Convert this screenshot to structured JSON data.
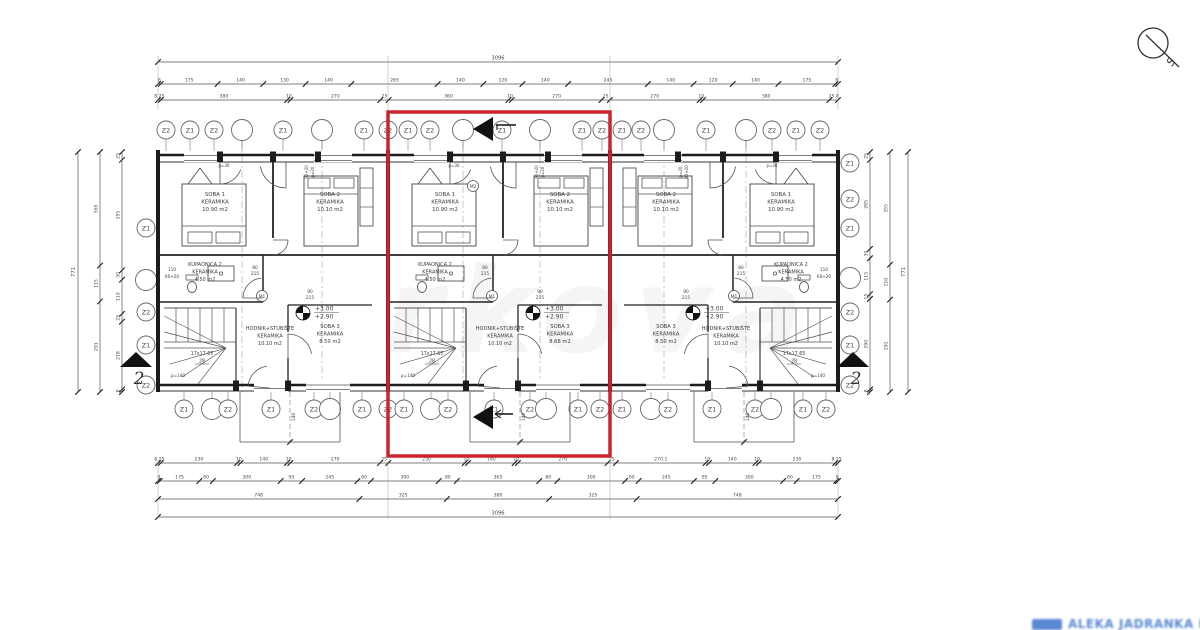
{
  "colors": {
    "line": "#555555",
    "dark": "#1c1c1c",
    "text": "#3c3c3c",
    "dim": "#474747",
    "red": "#c9252d",
    "blue": "#4c7fd0",
    "grid": "#8a8a8a"
  },
  "compass": {
    "label": "S"
  },
  "section_label": "2",
  "watermark_center": "rkova",
  "watermark_bottom": "ALEKA JADRANKA DJENĐ",
  "highlight": {
    "x": 388,
    "y": 112,
    "w": 222,
    "h": 344
  },
  "dim_rows_top": [
    {
      "y": 62,
      "x0": 158,
      "x1": 838,
      "single": true,
      "values": [
        "3096"
      ]
    },
    {
      "y": 84,
      "x0": 158,
      "x1": 838,
      "values": [
        8,
        175,
        140,
        130,
        140,
        265,
        140,
        120,
        140,
        245,
        140,
        120,
        140,
        175,
        8
      ]
    },
    {
      "y": 100,
      "x0": 158,
      "x1": 838,
      "values": [
        8.25,
        380,
        10,
        270,
        25,
        360,
        10,
        270,
        25,
        270,
        10,
        380,
        25.8
      ]
    }
  ],
  "dim_rows_bottom": [
    {
      "y": 463,
      "x0": 158,
      "x1": 838,
      "values": [
        8.25,
        230,
        10,
        140,
        10,
        270,
        25,
        230,
        10,
        140,
        10,
        270,
        25,
        270.1,
        10,
        140,
        10,
        230,
        8.25
      ]
    },
    {
      "y": 481,
      "x0": 158,
      "x1": 838,
      "values": [
        8,
        175,
        60,
        300,
        95,
        245,
        60,
        300,
        80,
        365,
        80,
        300,
        60,
        245,
        95,
        300,
        60,
        175,
        8
      ]
    },
    {
      "y": 499,
      "x0": 158,
      "x1": 838,
      "values": [
        748,
        325,
        380,
        325,
        748
      ]
    },
    {
      "y": 517,
      "x0": 158,
      "x1": 838,
      "single": true,
      "values": [
        "3096"
      ]
    }
  ],
  "dim_cols_left": [
    {
      "x": 78,
      "y0": 152,
      "y1": 392,
      "single": true,
      "values": [
        "771"
      ]
    },
    {
      "x": 100,
      "y0": 152,
      "y1": 392,
      "values": [
        365,
        115,
        291
      ]
    },
    {
      "x": 122,
      "y0": 152,
      "y1": 392,
      "values": [
        25,
        355,
        30,
        110,
        25,
        218,
        8
      ]
    }
  ],
  "dim_cols_right": [
    {
      "x": 870,
      "y0": 152,
      "y1": 392,
      "values": [
        25,
        285,
        30,
        115,
        15,
        290,
        8
      ]
    },
    {
      "x": 890,
      "y0": 152,
      "y1": 392,
      "values": [
        355,
        110,
        291
      ]
    },
    {
      "x": 908,
      "y0": 152,
      "y1": 392,
      "single": true,
      "values": [
        "771"
      ]
    }
  ],
  "grid_top": [
    {
      "x": 166,
      "label": "Z2"
    },
    {
      "x": 190,
      "label": "Z1"
    },
    {
      "x": 214,
      "label": "Z2"
    },
    {
      "x": 242,
      "label": ""
    },
    {
      "x": 283,
      "label": "Z1"
    },
    {
      "x": 322,
      "label": ""
    },
    {
      "x": 364,
      "label": "Z1"
    },
    {
      "x": 388,
      "label": "Z2"
    },
    {
      "x": 408,
      "label": "Z1"
    },
    {
      "x": 430,
      "label": "Z2"
    },
    {
      "x": 463,
      "label": ""
    },
    {
      "x": 502,
      "label": "Z1"
    },
    {
      "x": 540,
      "label": ""
    },
    {
      "x": 582,
      "label": "Z1"
    },
    {
      "x": 602,
      "label": "Z2"
    },
    {
      "x": 622,
      "label": "Z1"
    },
    {
      "x": 641,
      "label": "Z2"
    },
    {
      "x": 664,
      "label": ""
    },
    {
      "x": 706,
      "label": "Z1"
    },
    {
      "x": 746,
      "label": ""
    },
    {
      "x": 772,
      "label": "Z2"
    },
    {
      "x": 796,
      "label": "Z1"
    },
    {
      "x": 820,
      "label": "Z2"
    }
  ],
  "grid_bottom": [
    {
      "x": 184,
      "label": "Z1"
    },
    {
      "x": 212,
      "label": ""
    },
    {
      "x": 228,
      "label": "Z2"
    },
    {
      "x": 271,
      "label": "Z1"
    },
    {
      "x": 314,
      "label": "Z2"
    },
    {
      "x": 330,
      "label": ""
    },
    {
      "x": 362,
      "label": "Z1"
    },
    {
      "x": 388,
      "label": "Z2"
    },
    {
      "x": 404,
      "label": "Z1"
    },
    {
      "x": 431,
      "label": ""
    },
    {
      "x": 448,
      "label": "Z2"
    },
    {
      "x": 494,
      "label": "Z1"
    },
    {
      "x": 530,
      "label": "Z2"
    },
    {
      "x": 546,
      "label": ""
    },
    {
      "x": 578,
      "label": "Z1"
    },
    {
      "x": 600,
      "label": "Z2"
    },
    {
      "x": 622,
      "label": "Z1"
    },
    {
      "x": 651,
      "label": ""
    },
    {
      "x": 668,
      "label": "Z2"
    },
    {
      "x": 712,
      "label": "Z1"
    },
    {
      "x": 755,
      "label": "Z2"
    },
    {
      "x": 771,
      "label": ""
    },
    {
      "x": 803,
      "label": "Z1"
    },
    {
      "x": 826,
      "label": "Z2"
    }
  ],
  "grid_left": [
    {
      "y": 228,
      "label": "Z1"
    },
    {
      "y": 280,
      "label": ""
    },
    {
      "y": 312,
      "label": "Z2"
    },
    {
      "y": 345,
      "label": "Z1"
    },
    {
      "y": 385,
      "label": "Z2"
    }
  ],
  "grid_right": [
    {
      "y": 163,
      "label": "Z1"
    },
    {
      "y": 199,
      "label": "Z2"
    },
    {
      "y": 228,
      "label": "Z1"
    },
    {
      "y": 278,
      "label": ""
    },
    {
      "y": 312,
      "label": "Z2"
    },
    {
      "y": 345,
      "label": "Z1"
    },
    {
      "y": 385,
      "label": "Z2"
    }
  ],
  "units": [
    {
      "x": 158,
      "w": 230,
      "mirrored": false,
      "soba1": [
        "SOBA 1",
        "KERAMIKA",
        "10.90 m2"
      ],
      "soba2": [
        "SOBA 2",
        "KERAMIKA",
        "10.10 m2"
      ],
      "kupaonica": [
        "KUPAONICA 2",
        "KERAMIKA",
        "4.50 m2"
      ],
      "hodnik": [
        "HODNIK+STUBIŠTE",
        "KERAMIKA",
        "10.10 m2"
      ],
      "soba3": [
        "SOBA 3",
        "KERAMIKA",
        "8.50 m2"
      ],
      "level": [
        "+3.00",
        "+2.90"
      ],
      "stairs": [
        "17x17.65",
        "28",
        "p=140"
      ],
      "door_dims": [
        [
          "90",
          "215"
        ],
        [
          "80",
          "215"
        ]
      ],
      "top_dims": [
        "p=30",
        "90+20",
        "p=20"
      ],
      "bath_note": [
        "110",
        "60+20"
      ],
      "machines": [
        "M1"
      ],
      "porch_dim": "140"
    },
    {
      "x": 388,
      "w": 222,
      "mirrored": false,
      "soba1": [
        "SOBA 1",
        "KERAMIKA",
        "10.90 m2"
      ],
      "soba2": [
        "SOBA 2",
        "KERAMIKA",
        "10.10 m2"
      ],
      "kupaonica": [
        "KUPAONICA 2",
        "KERAMIKA",
        "4.50 m2"
      ],
      "hodnik": [
        "HODNIK+STUBIŠTE",
        "KERAMIKA",
        "10.10 m2"
      ],
      "soba3": [
        "SOBA 3",
        "KERAMIKA",
        "8.68 m2"
      ],
      "level": [
        "+3.00",
        "+2.90"
      ],
      "stairs": [
        "17x17.65",
        "28",
        "p=140"
      ],
      "door_dims": [
        [
          "90",
          "215"
        ],
        [
          "80",
          "215"
        ]
      ],
      "top_dims": [
        "p=30",
        "90+20",
        "p=20"
      ],
      "bath_note": [],
      "machines": [
        "M1",
        "M2"
      ],
      "porch_dim": "140"
    },
    {
      "x": 612,
      "w": 226,
      "mirrored": true,
      "soba1": [
        "SOBA 1",
        "KERAMIKA",
        "10.90 m2"
      ],
      "soba2": [
        "SOBA 2",
        "KERAMIKA",
        "10.10 m2"
      ],
      "kupaonica": [
        "KUPAONICA 2",
        "KERAMIKA",
        "4.50 m2"
      ],
      "hodnik": [
        "HODNIK+STUBIŠTE",
        "KERAMIKA",
        "10.10 m2"
      ],
      "soba3": [
        "SOBA 3",
        "KERAMIKA",
        "8.50 m2"
      ],
      "level": [
        "+3.00",
        "+2.90"
      ],
      "stairs": [
        "17x17.65",
        "28",
        "p=140"
      ],
      "door_dims": [
        [
          "90",
          "215"
        ],
        [
          "80",
          "215"
        ]
      ],
      "top_dims": [
        "p=30",
        "90+20",
        "p=20"
      ],
      "bath_note": [
        "110",
        "60+20"
      ],
      "machines": [
        "M1"
      ],
      "porch_dim": "140"
    }
  ]
}
